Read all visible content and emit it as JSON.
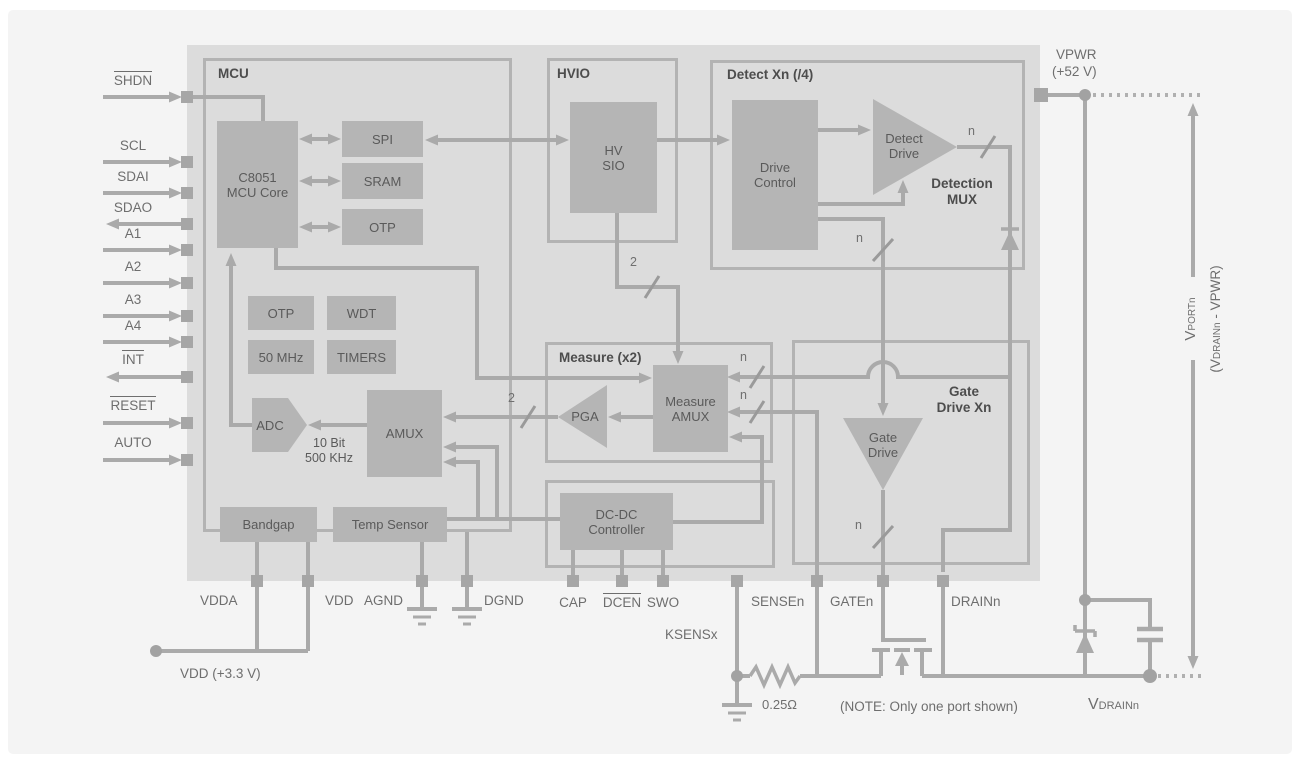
{
  "diagram": {
    "sections": {
      "mcu": "MCU",
      "hvio": "HVIO",
      "detect": "Detect Xn (/4)",
      "measure": "Measure (x2)",
      "gate_line1": "Gate",
      "gate_line2": "Drive Xn",
      "detection_mux_line1": "Detection",
      "detection_mux_line2": "MUX"
    },
    "blocks": {
      "core_line1": "C8051",
      "core_line2": "MCU Core",
      "spi": "SPI",
      "sram": "SRAM",
      "otp_top": "OTP",
      "otp_small": "OTP",
      "wdt": "WDT",
      "clock": "50 MHz",
      "timers": "TIMERS",
      "adc": "ADC",
      "adc_note_line1": "10 Bit",
      "adc_note_line2": "500 KHz",
      "amux": "AMUX",
      "bandgap": "Bandgap",
      "temp_sensor": "Temp Sensor",
      "hv_sio_line1": "HV",
      "hv_sio_line2": "SIO",
      "drive_control_line1": "Drive",
      "drive_control_line2": "Control",
      "detect_drive_line1": "Detect",
      "detect_drive_line2": "Drive",
      "measure_amux_line1": "Measure",
      "measure_amux_line2": "AMUX",
      "pga": "PGA",
      "dcdc_line1": "DC-DC",
      "dcdc_line2": "Controller",
      "gate_drive_line1": "Gate",
      "gate_drive_line2": "Drive"
    },
    "pins_left": [
      {
        "label": "SHDN",
        "overline": true,
        "direction": "in"
      },
      {
        "label": "SCL",
        "overline": false,
        "direction": "in"
      },
      {
        "label": "SDAI",
        "overline": false,
        "direction": "in"
      },
      {
        "label": "SDAO",
        "overline": false,
        "direction": "out"
      },
      {
        "label": "A1",
        "overline": false,
        "direction": "in"
      },
      {
        "label": "A2",
        "overline": false,
        "direction": "in"
      },
      {
        "label": "A3",
        "overline": false,
        "direction": "in"
      },
      {
        "label": "A4",
        "overline": false,
        "direction": "in"
      },
      {
        "label": "INT",
        "overline": true,
        "direction": "out"
      },
      {
        "label": "RESET",
        "overline": true,
        "direction": "in"
      },
      {
        "label": "AUTO",
        "overline": false,
        "direction": "in"
      }
    ],
    "pins_bottom": [
      {
        "label": "VDDA"
      },
      {
        "label": "VDD"
      },
      {
        "label": "AGND"
      },
      {
        "label": "DGND"
      },
      {
        "label": "CAP"
      },
      {
        "label": "DCEN",
        "overline": true
      },
      {
        "label": "SWO"
      },
      {
        "label": "KSENSx"
      },
      {
        "label": "SENSEn"
      },
      {
        "label": "GATEn"
      },
      {
        "label": "DRAINn"
      }
    ],
    "bus": {
      "n": "n",
      "two": "2"
    },
    "right": {
      "vpwr": "VPWR",
      "vpwr_voltage": "(+52 V)",
      "vport_main": "V",
      "vport_sub": "PORTn",
      "vdiff_pre": "(V",
      "vdiff_sub": "DRAINn",
      "vdiff_post": " - VPWR)",
      "vdrain_main": "V",
      "vdrain_sub": "DRAINn"
    },
    "annotations": {
      "vdd_rail": "VDD (+3.3 V)",
      "shunt_resistor": "0.25Ω",
      "note": "(NOTE: Only one port shown)"
    },
    "colors": {
      "panel": "#f4f4f4",
      "chip_fill": "#dcdcdc",
      "block_fill": "#b5b5b5",
      "wire": "#aaaaaa",
      "box_border": "#b3b3b3",
      "text_dark": "#4d4d4d",
      "text_block": "#5a5a5a",
      "text_outside": "#6e6e6e"
    }
  }
}
